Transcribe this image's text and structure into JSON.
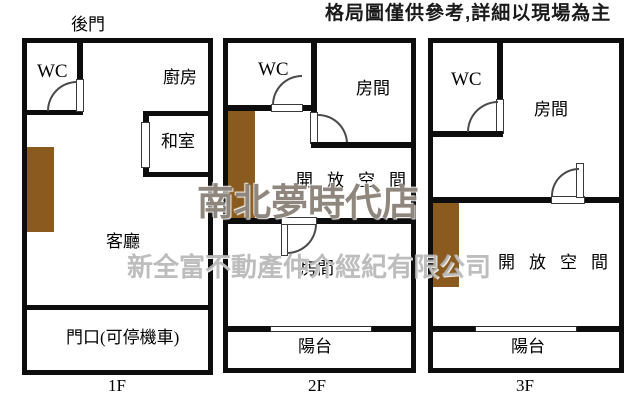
{
  "title": "格局圖僅供參考,詳細以現場為主",
  "watermarks": {
    "line1": "南北夢時代店",
    "line2": "新全富不動產仲介經紀有限公司"
  },
  "colors": {
    "wall": "#0d0d0d",
    "stairs": "#8a5a1e",
    "background": "#ffffff"
  },
  "floors": [
    {
      "label": "1F",
      "rooms": {
        "back_door": "後門",
        "wc": "WC",
        "kitchen": "廚房",
        "tatami": "和室",
        "living": "客廳",
        "entrance": "門口(可停機車)"
      }
    },
    {
      "label": "2F",
      "rooms": {
        "wc": "WC",
        "room_top": "房間",
        "open_space": "開放空間",
        "room_bottom": "房間",
        "balcony": "陽台"
      }
    },
    {
      "label": "3F",
      "rooms": {
        "wc": "WC",
        "room": "房間",
        "open_space": "開放空間",
        "balcony": "陽台"
      }
    }
  ]
}
